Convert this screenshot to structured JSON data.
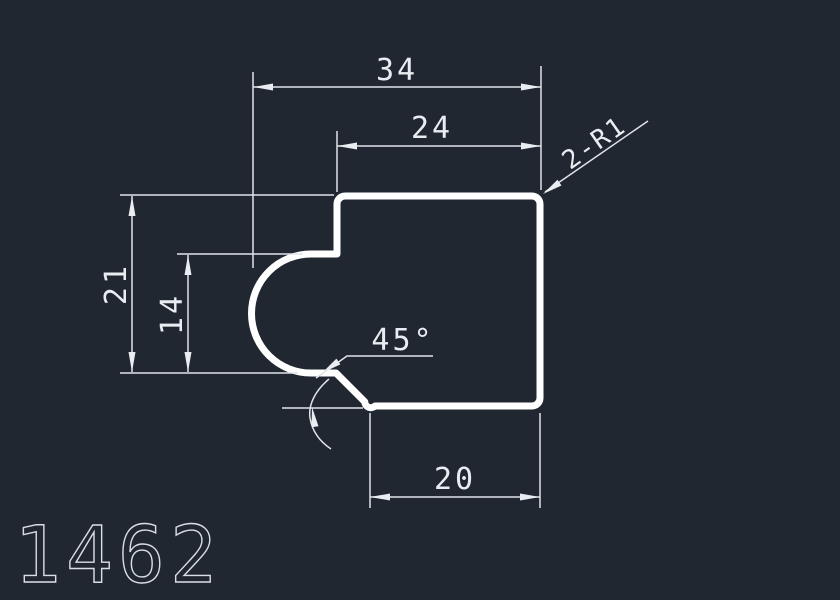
{
  "drawing": {
    "part_number": "1462",
    "dims": {
      "total_width": "34",
      "top_width": "24",
      "total_height": "21",
      "pocket_height": "14",
      "chamfer_angle": "45°",
      "bottom_width": "20",
      "fillet_note": "2-R1"
    },
    "colors": {
      "background": "#202731",
      "outline": "#ffffff",
      "annotation": "#e9edf2"
    }
  }
}
